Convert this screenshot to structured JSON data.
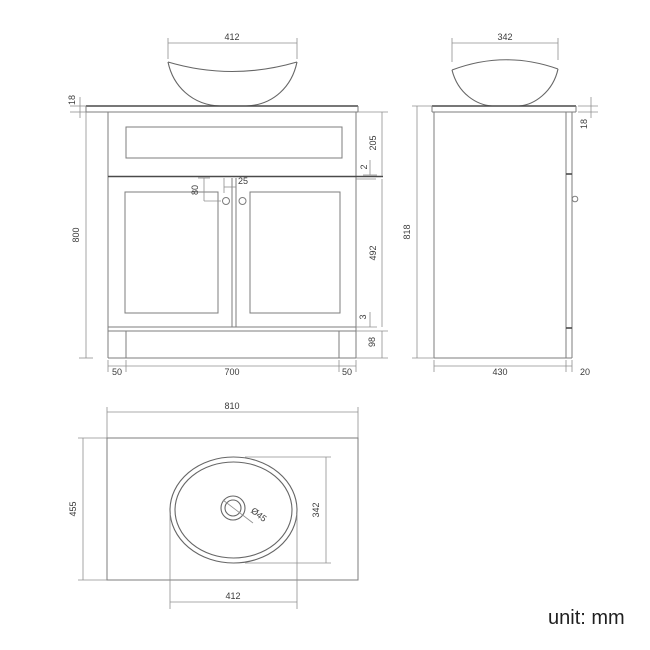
{
  "drawing": {
    "unit_label": "unit: mm",
    "front_view": {
      "bowl_width": "412",
      "countertop_thickness": "18",
      "cabinet_height": "800",
      "drawer_panel_height": "205",
      "drawer_door_gap": "2",
      "knob_vertical_offset": "80",
      "knob_horizontal_offset": "25",
      "door_height": "492",
      "door_plinth_gap": "3",
      "plinth_height": "98",
      "left_leg_width": "50",
      "center_width": "700",
      "right_leg_width": "50"
    },
    "side_view": {
      "bowl_depth": "342",
      "countertop_thickness": "18",
      "overall_height": "818",
      "cabinet_depth": "430",
      "door_thickness": "20"
    },
    "top_view": {
      "countertop_width": "810",
      "countertop_depth": "455",
      "basin_depth": "342",
      "basin_width": "412",
      "drain_diameter": "Ø45"
    }
  }
}
